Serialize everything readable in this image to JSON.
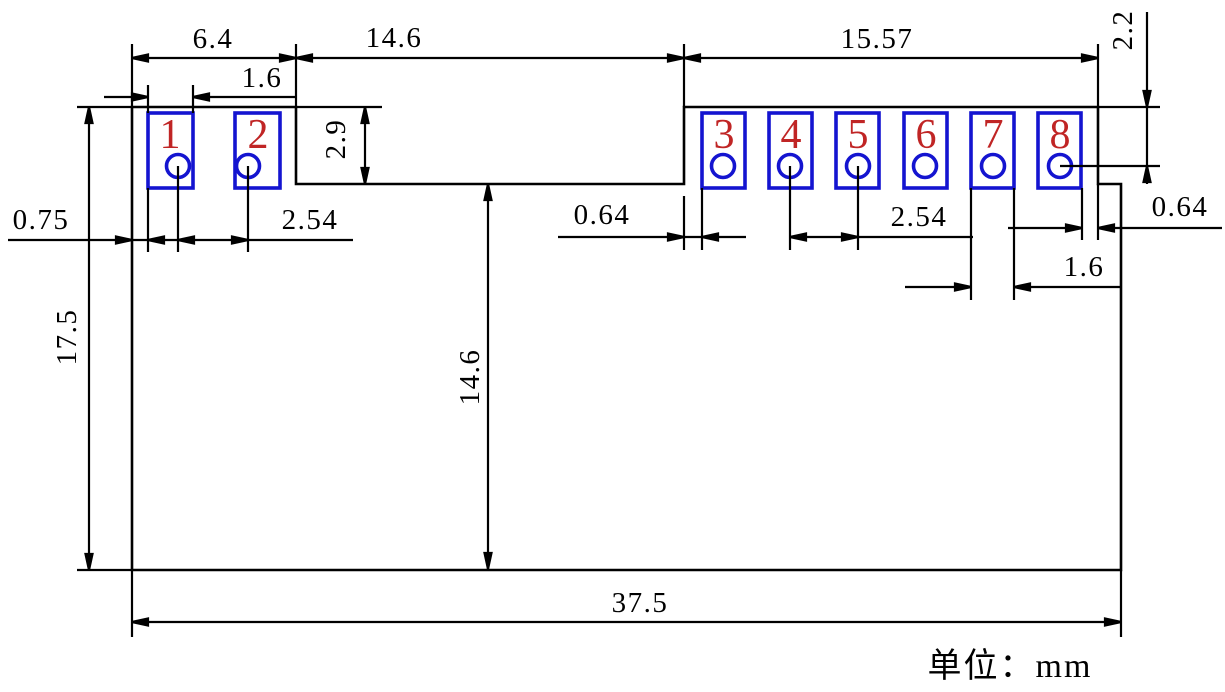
{
  "drawing": {
    "type": "pcb-module-footprint-dimension-drawing",
    "unit_note": "单位：mm",
    "colors": {
      "line": "#000000",
      "pad_outline": "#1414d0",
      "pad_number": "#c02525",
      "background": "#ffffff"
    },
    "pads": [
      {
        "number": "1"
      },
      {
        "number": "2"
      },
      {
        "number": "3"
      },
      {
        "number": "4"
      },
      {
        "number": "5"
      },
      {
        "number": "6"
      },
      {
        "number": "7"
      },
      {
        "number": "8"
      }
    ],
    "dims": {
      "top_width_left": "6.4",
      "pad_width_left": "1.6",
      "notch_width": "14.6",
      "right_width": "15.57",
      "top_offset_right": "2.2",
      "notch_depth": "2.9",
      "left_edge_gap": "0.75",
      "pitch_left": "2.54",
      "notch_pad_gap": "0.64",
      "pitch_right": "2.54",
      "pad_width_right": "1.6",
      "pad_edge_gap_right": "0.64",
      "body_height": "17.5",
      "notch_to_bottom": "14.6",
      "total_width": "37.5"
    }
  }
}
